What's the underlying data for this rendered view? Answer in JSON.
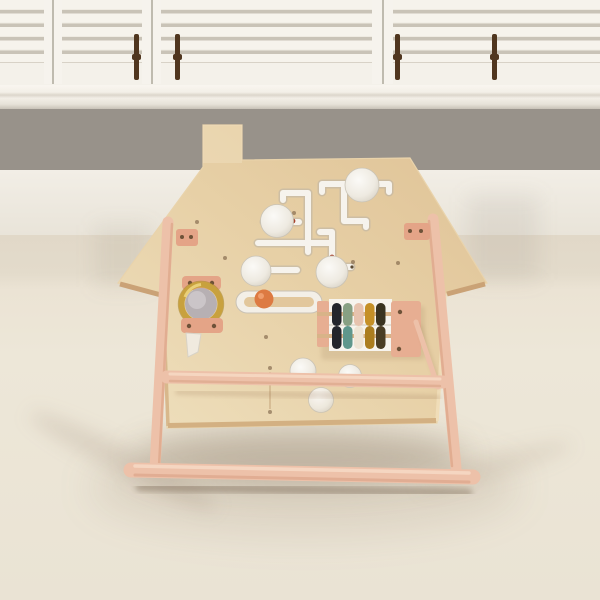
{
  "scene": {
    "description": "Photograph of a natural wood house-shaped activity busy board toy standing on a pink-beech A-frame stand on beige carpet, in front of white plantation shutter windows and a warm gray wall. The board has a chimney, a cut-out marble maze with white slider knobs, a brass mirror ring, an orange bead slider slot, and a small abacus with colored beads.",
    "objects": [
      "plantation shutters",
      "window sill",
      "gray wall",
      "white baseboard wall",
      "beige carpet",
      "house-shaped busy board",
      "chimney",
      "maze tracks",
      "white slider knobs",
      "brass mirror ring",
      "orange slider bead",
      "abacus with colored beads",
      "wooden mallet stick",
      "A-frame stand legs",
      "crossbar",
      "foot bar",
      "hinge brackets",
      "screws"
    ]
  },
  "window": {
    "panel_count": 3,
    "louver_rows": 5,
    "tilt_rod_count": 4,
    "frame_color": "#f6f3ed",
    "seam_color": "#b2ac9f",
    "rod_color": "#50361f"
  },
  "wall": {
    "upper_gray": "#98928a",
    "lower_white": "#f1ede5",
    "sill_white": "#f6f3ec"
  },
  "floor": {
    "carpet_upper": "#e1d8c8",
    "carpet_lower": "#ede7d8"
  },
  "toy": {
    "name": "wooden house busy board with stand",
    "board_wood": "#e4cba1",
    "edge_wood": "#d3b082",
    "stand_wood": "#edc1a9",
    "bracket_wood": "#e4a487",
    "screw_color": "#6e5238",
    "hook_color": "#f0eadf",
    "maze": {
      "track_color": "#f6f3ed",
      "groove_edge": "#b6b0a6",
      "knob_color": "#f1eee7",
      "knob_count": 7,
      "marker_color": "#a8402a"
    },
    "mirror_ring": {
      "ring_color": "#c8a13e",
      "ring_shadow": "#a07f28",
      "mirror_color": "#b7b0b3"
    },
    "slider": {
      "slot_color": "#f3efe7",
      "island_color": "#e2c79c",
      "bead_color": "#dd7a42"
    },
    "abacus": {
      "frame_color": "#e7ae92",
      "panel_color": "#f7f4ee",
      "rod_color": "#d8b388",
      "top_row": [
        "#23252b",
        "#87a083",
        "#e7c3ae",
        "#c59027",
        "#3a3320"
      ],
      "bottom_row": [
        "#23252b",
        "#5f978c",
        "#eee4d4",
        "#ab7d1f",
        "#4a3d24"
      ]
    }
  }
}
